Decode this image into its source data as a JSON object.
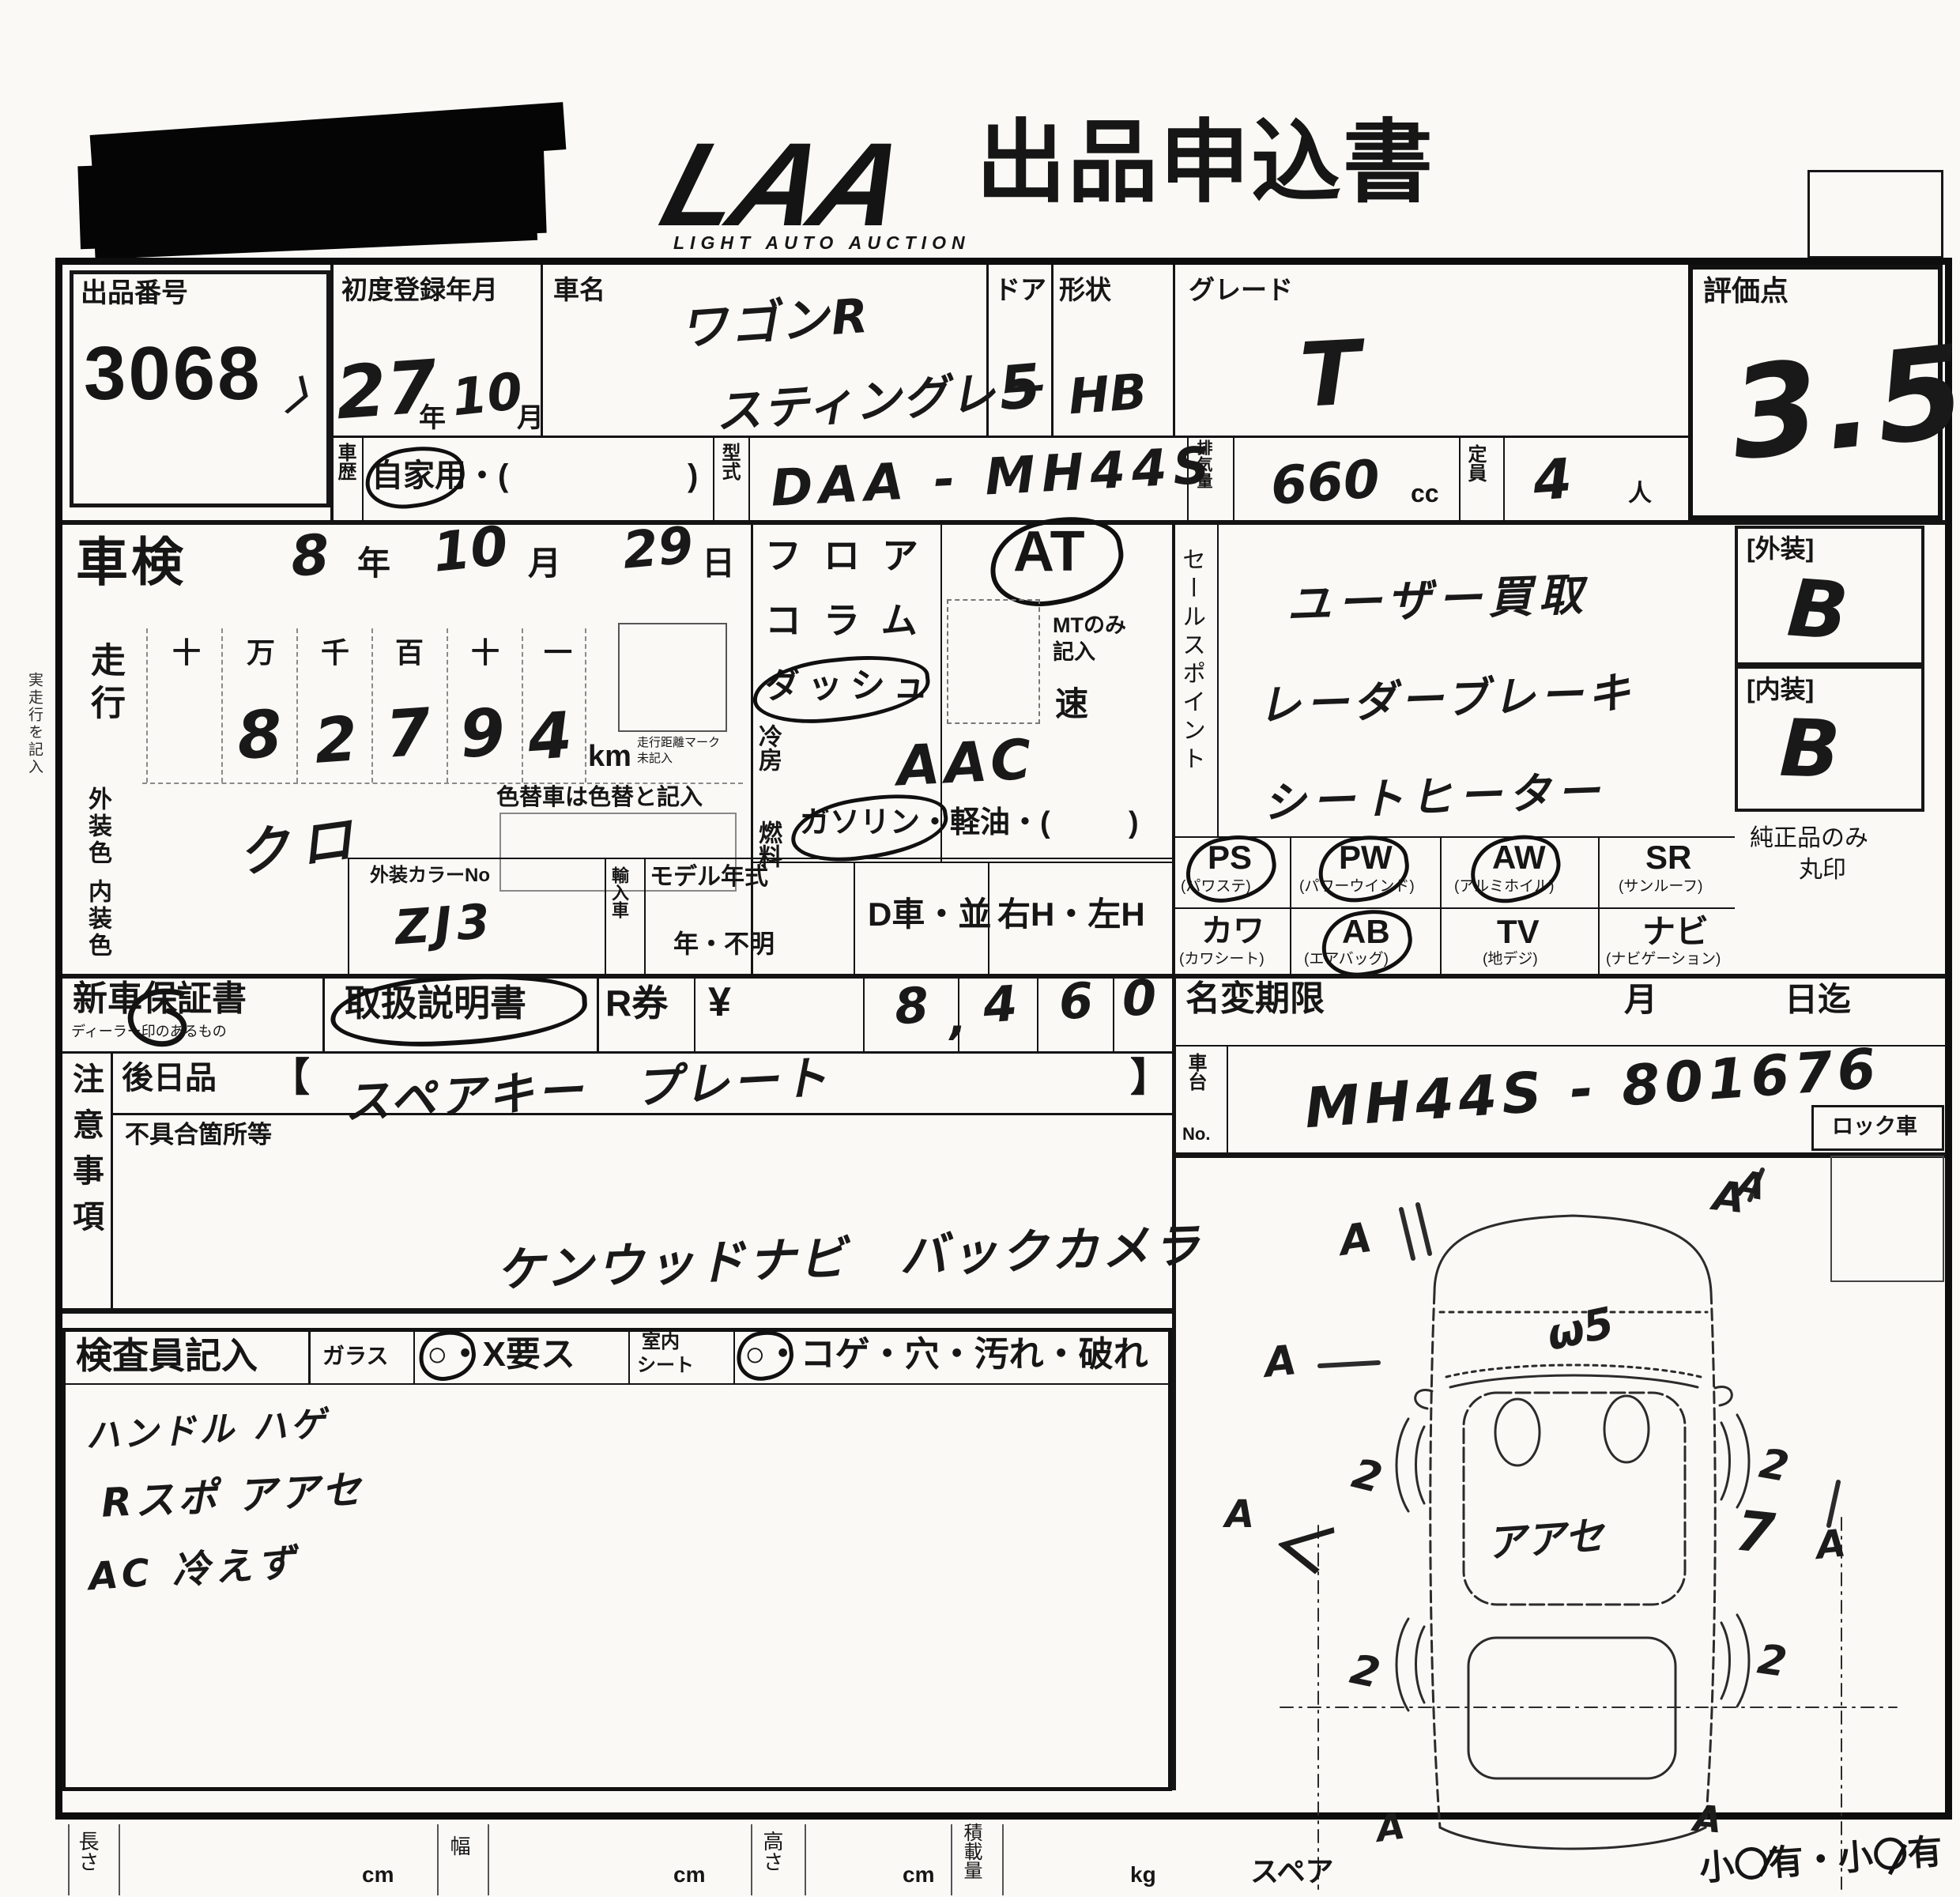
{
  "header": {
    "logo_main": "LAA",
    "logo_sub": "LIGHT AUTO AUCTION",
    "title": "出品申込書"
  },
  "top": {
    "lot_label": "出品番号",
    "lot_number": "3068",
    "lot_tick": "〉",
    "first_reg_label": "初度登録年月",
    "first_reg_year": "27",
    "year_unit": "年",
    "first_reg_month": "10",
    "month_unit": "月",
    "car_name_label": "車名",
    "car_name_line1": "ワゴンR",
    "car_name_line2": "スティングレー",
    "door_label": "ドア",
    "door_value": "5",
    "shape_label": "形状",
    "shape_value": "HB",
    "grade_label": "グレード",
    "grade_value": "T",
    "score_label": "評価点",
    "score_value": "3.5",
    "history_label": "車歴",
    "history_open": "自家用・(",
    "history_close": ")",
    "model_code_label": "型式",
    "model_code_value": "DAA - MH44S",
    "disp_label": "排気量",
    "disp_value": "660",
    "disp_unit": "cc",
    "cap_label": "定員",
    "cap_value": "4",
    "cap_unit": "人"
  },
  "inspection": {
    "margin_note": "実走行を記入",
    "shaken_label": "車検",
    "shaken_year": "8",
    "y_unit": "年",
    "shaken_month": "10",
    "m_unit": "月",
    "shaken_day": "29",
    "d_unit": "日",
    "mileage_label": "走行",
    "digit_headers": [
      "十",
      "万",
      "千",
      "百",
      "十",
      "一"
    ],
    "digits": [
      "8",
      "2",
      "7",
      "9",
      "4"
    ],
    "km_label": "km",
    "km_note1": "走行距離マーク",
    "km_note2": "未記入",
    "repaint_note": "色替車は色替と記入",
    "ext_color_label": "外装色",
    "ext_color_value": "クロ",
    "color_no_label": "外装カラーNo",
    "color_no_value": "ZJ3",
    "int_color_label": "内装色",
    "import_label": "輸入車",
    "model_year_label": "モデル年式",
    "year_unknown": "年・不明",
    "dealer_car": "D車・並",
    "handle": "右H・左H"
  },
  "trans": {
    "row1": "フロア",
    "row2": "コラム",
    "row3": "ダッシュ",
    "at_value": "AT",
    "mt_note1": "MTのみ",
    "mt_note2": "記入",
    "speed": "速",
    "ac_label": "冷房",
    "ac_value": "AAC",
    "fuel_label": "燃料",
    "fuel_open": "ガソリン・軽油・(",
    "fuel_close": ")"
  },
  "sales": {
    "label": "セールスポイント",
    "line1": "ユーザー買取",
    "line2": "レーダーブレーキ",
    "line3": "シートヒーター"
  },
  "equipment": {
    "items": [
      {
        "code": "PS",
        "name": "(パワステ)",
        "circled": true
      },
      {
        "code": "PW",
        "name": "(パワーウインド)",
        "circled": true
      },
      {
        "code": "AW",
        "name": "(アルミホイル)",
        "circled": true
      },
      {
        "code": "SR",
        "name": "(サンルーフ)",
        "circled": false
      },
      {
        "code": "カワ",
        "name": "(カワシート)",
        "circled": false
      },
      {
        "code": "AB",
        "name": "(エアバッグ)",
        "circled": true
      },
      {
        "code": "TV",
        "name": "(地デジ)",
        "circled": false
      },
      {
        "code": "ナビ",
        "name": "(ナビゲーション)",
        "circled": false
      }
    ]
  },
  "grades": {
    "ext_label": "[外装]",
    "ext_value": "B",
    "int_label": "[内装]",
    "int_value": "B",
    "genuine1": "純正品のみ",
    "genuine2": "丸印"
  },
  "docs": {
    "warranty_label": "新車保証書",
    "warranty_note": "ディーラー印のあるもの",
    "manual_label": "取扱説明書",
    "rticket_label": "R券",
    "yen": "¥",
    "price_digits": [
      "8",
      "4",
      "6",
      "0"
    ],
    "price_comma": ",",
    "rename_label": "名変期限",
    "month_unit": "月",
    "until": "日迄",
    "chassis_label1": "車台",
    "chassis_label2": "No.",
    "chassis_value": "MH44S - 801676",
    "later_label": "後日品",
    "bracket_open": "【",
    "later_value": "スペアキー　プレート",
    "bracket_close": "】"
  },
  "caution": {
    "label": "注意事項",
    "defect_label": "不具合箇所等",
    "note": "ケンウッドナビ　バックカメラ"
  },
  "inspector": {
    "label": "検査員記入",
    "glass_label": "ガラス",
    "glass_options": "○・X要ス",
    "seat_label1": "室内",
    "seat_label2": "シート",
    "seat_options": "○・コゲ・穴・汚れ・破れ",
    "note1": "ハンドル ハゲ",
    "note2": "Rスポ アアセ",
    "note3": "AC 冷えず"
  },
  "diagram": {
    "lock_label": "ロック車",
    "a_mark": "A",
    "roof_mark": "ω5",
    "center_mark": "アアセ",
    "rear_left_mark": "＜",
    "rear_right_mark": "7",
    "wheel_marks": [
      "2",
      "2",
      "2",
      "2"
    ]
  },
  "footer": {
    "length_label": "長さ",
    "width_label": "幅",
    "height_label": "高さ",
    "load_label": "積載量",
    "cm": "cm",
    "kg": "kg",
    "spare_label": "スペア",
    "small_label": "小〇有・小〇有"
  }
}
